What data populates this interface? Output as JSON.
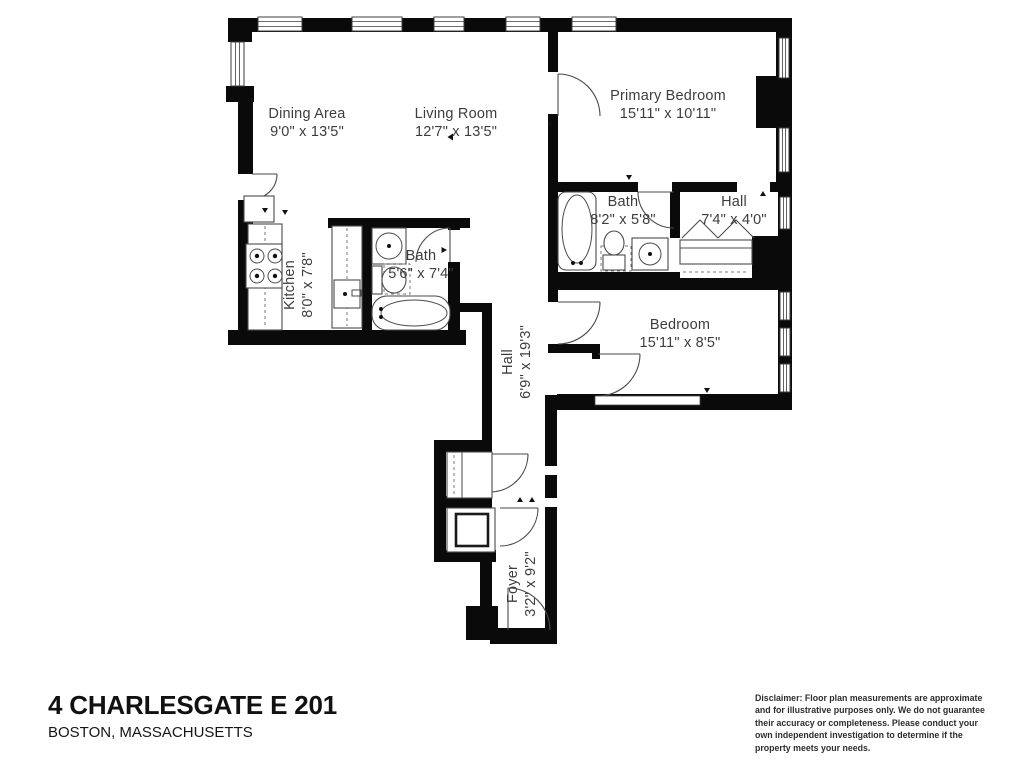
{
  "meta": {
    "property_title": "4 CHARLESGATE E 201",
    "property_location": "BOSTON, MASSACHUSETTS"
  },
  "disclaimer": "Disclaimer: Floor plan measurements are approximate and for illustrative purposes only. We do not guarantee their accuracy or completeness. Please conduct your own independent investigation to determine if the property meets your needs.",
  "rooms": [
    {
      "name": "Dining Area",
      "dims": "9'0\" x 13'5\""
    },
    {
      "name": "Living Room",
      "dims": "12'7\" x 13'5\""
    },
    {
      "name": "Primary Bedroom",
      "dims": "15'11\" x 10'11\""
    },
    {
      "name": "Bath",
      "dims": "8'2\" x 5'8\""
    },
    {
      "name": "Hall",
      "dims": "7'4\" x 4'0\""
    },
    {
      "name": "Kitchen",
      "dims": "8'0\" x 7'8\""
    },
    {
      "name": "Bath",
      "dims": "5'6\" x 7'4\""
    },
    {
      "name": "Bedroom",
      "dims": "15'11\" x 8'5\""
    },
    {
      "name": "Hall",
      "dims": "6'9\" x 19'3\""
    },
    {
      "name": "Foyer",
      "dims": "3'2\" x 9'2\""
    }
  ],
  "colors": {
    "wall": "#0a0a0a",
    "label_text": "#3d3d3d",
    "fixture_stroke": "#4a4a4a",
    "background": "#ffffff"
  }
}
